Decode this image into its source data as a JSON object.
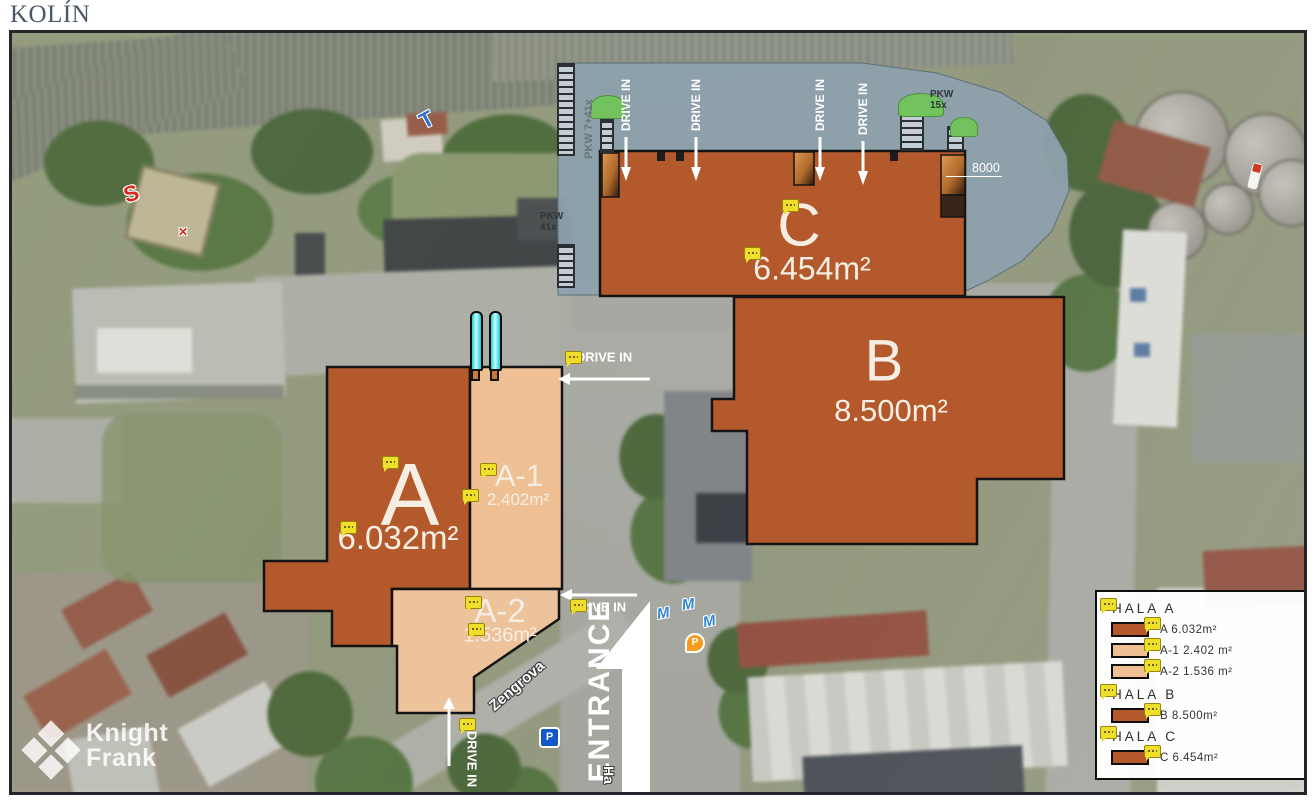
{
  "page": {
    "title": "KOLÍN"
  },
  "watermark": {
    "line1": "Knight",
    "line2": "Frank"
  },
  "map": {
    "halls": {
      "a": {
        "name": "A",
        "area": "6.032m²"
      },
      "a1": {
        "name": "A-1",
        "area": "2.402m²"
      },
      "a2": {
        "name": "A-2",
        "area": "1.536m²"
      },
      "b": {
        "name": "B",
        "area": "8.500m²"
      },
      "c": {
        "name": "C",
        "area": "6.454m²"
      }
    },
    "annotations": {
      "drive_in": "DRIVE IN",
      "entrance": "ENTRANCE",
      "dimension": "8000",
      "parking_left": "PKW 7+41x",
      "parking_right": "PKW 15x",
      "parking_small": "PKW 41x",
      "street": "Zengrova",
      "street_partial": "Ha"
    },
    "icons": {
      "s_marker": "S",
      "t_marker": "T",
      "cross_marker": "✕",
      "parking_sign": "P",
      "parking_pin": "P",
      "wave_pin": "M"
    }
  },
  "legend": {
    "sections": [
      {
        "title": "HALA A",
        "rows": [
          {
            "label": "A 6.032m²",
            "swatch": "#b3592b"
          },
          {
            "label": "A-1 2.402 m²",
            "swatch": "#eec094"
          },
          {
            "label": "A-2 1.536 m²",
            "swatch": "#eec094"
          }
        ]
      },
      {
        "title": "HALA B",
        "rows": [
          {
            "label": "B 8.500m²",
            "swatch": "#b3592b"
          }
        ]
      },
      {
        "title": "HALA C",
        "rows": [
          {
            "label": "C 6.454m²",
            "swatch": "#b3592b"
          }
        ]
      }
    ]
  },
  "colors": {
    "hall_dark": "#b3592b",
    "hall_light": "#eec094",
    "yard_gray": "#8da2ad",
    "marker_yellow": "#f0df2a",
    "chimney_cyan": "#19cfd8"
  }
}
